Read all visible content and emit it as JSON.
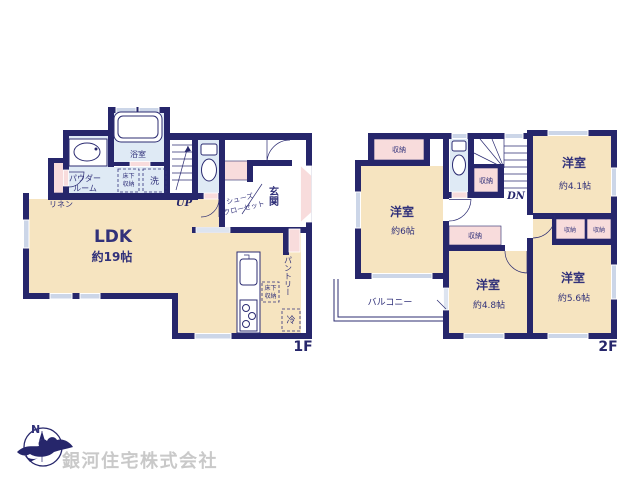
{
  "palette": {
    "wall_navy": "#26266b",
    "room_cream": "#f6e4c0",
    "wet_area_blue": "#dfeaf5",
    "closet_pink": "#f8dcdc",
    "window_gray": "#ccd6e8",
    "label_navy": "#31317a",
    "company_gray": "#c9c9c9"
  },
  "f1": {
    "label": "1F",
    "ldk_name": "LDK",
    "ldk_size": "約19帖",
    "bath": "浴室",
    "powder_line1": "パウダー",
    "powder_line2": "ルーム",
    "wash": "洗",
    "underfloor_a1": "床下",
    "underfloor_a2": "収納",
    "linen": "リネン",
    "up": "UP",
    "shoes_line1": "シューズ",
    "shoes_line2": "クローゼット",
    "genkan": "玄関",
    "pantry": "パントリー",
    "underfloor_b1": "床下",
    "underfloor_b2": "収納",
    "fridge": "冷"
  },
  "f2": {
    "label": "2F",
    "dn": "DN",
    "balcony": "バルコニー",
    "room6_name": "洋室",
    "room6_size": "約6帖",
    "room41_name": "洋室",
    "room41_size": "約4.1帖",
    "room48_name": "洋室",
    "room48_size": "約4.8帖",
    "room56_name": "洋室",
    "room56_size": "約5.6帖",
    "storage_topleft": "収納",
    "storage_stairs": "収納",
    "storage_hall": "収納",
    "storage_41a": "収納",
    "storage_41b": "収納"
  },
  "footer": {
    "compass_n": "N",
    "company": "銀河住宅株式会社"
  }
}
